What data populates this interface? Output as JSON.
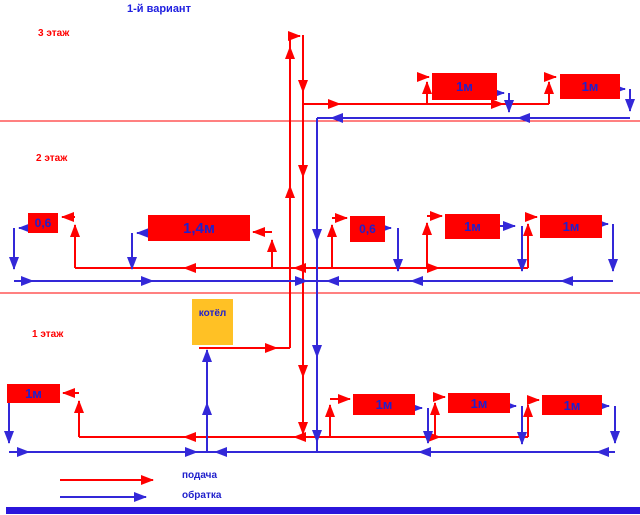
{
  "title": "1-й вариант",
  "floor_labels": [
    "3 этаж",
    "2 этаж",
    "1 этаж"
  ],
  "boiler_label": "котёл",
  "radiators": [
    {
      "floor": 3,
      "label": "1м"
    },
    {
      "floor": 3,
      "label": "1м"
    },
    {
      "floor": 2,
      "label": "0,6"
    },
    {
      "floor": 2,
      "label": "1,4м"
    },
    {
      "floor": 2,
      "label": "0,6"
    },
    {
      "floor": 2,
      "label": "1м"
    },
    {
      "floor": 2,
      "label": "1м"
    },
    {
      "floor": 1,
      "label": "1м"
    },
    {
      "floor": 1,
      "label": "1м"
    },
    {
      "floor": 1,
      "label": "1м"
    },
    {
      "floor": 1,
      "label": "1м"
    }
  ],
  "legend": {
    "supply_label": "подача",
    "return_label": "обратка"
  },
  "colors": {
    "supply_line": "#FF0000",
    "return_line": "#3328D8",
    "radiator_fill": "#FF0000",
    "radiator_text": "#2020CC",
    "boiler_fill": "#FFC125",
    "floor_divider": "#FF0000",
    "title_color": "#2020E0",
    "bottom_bar": "#2B16DB"
  }
}
